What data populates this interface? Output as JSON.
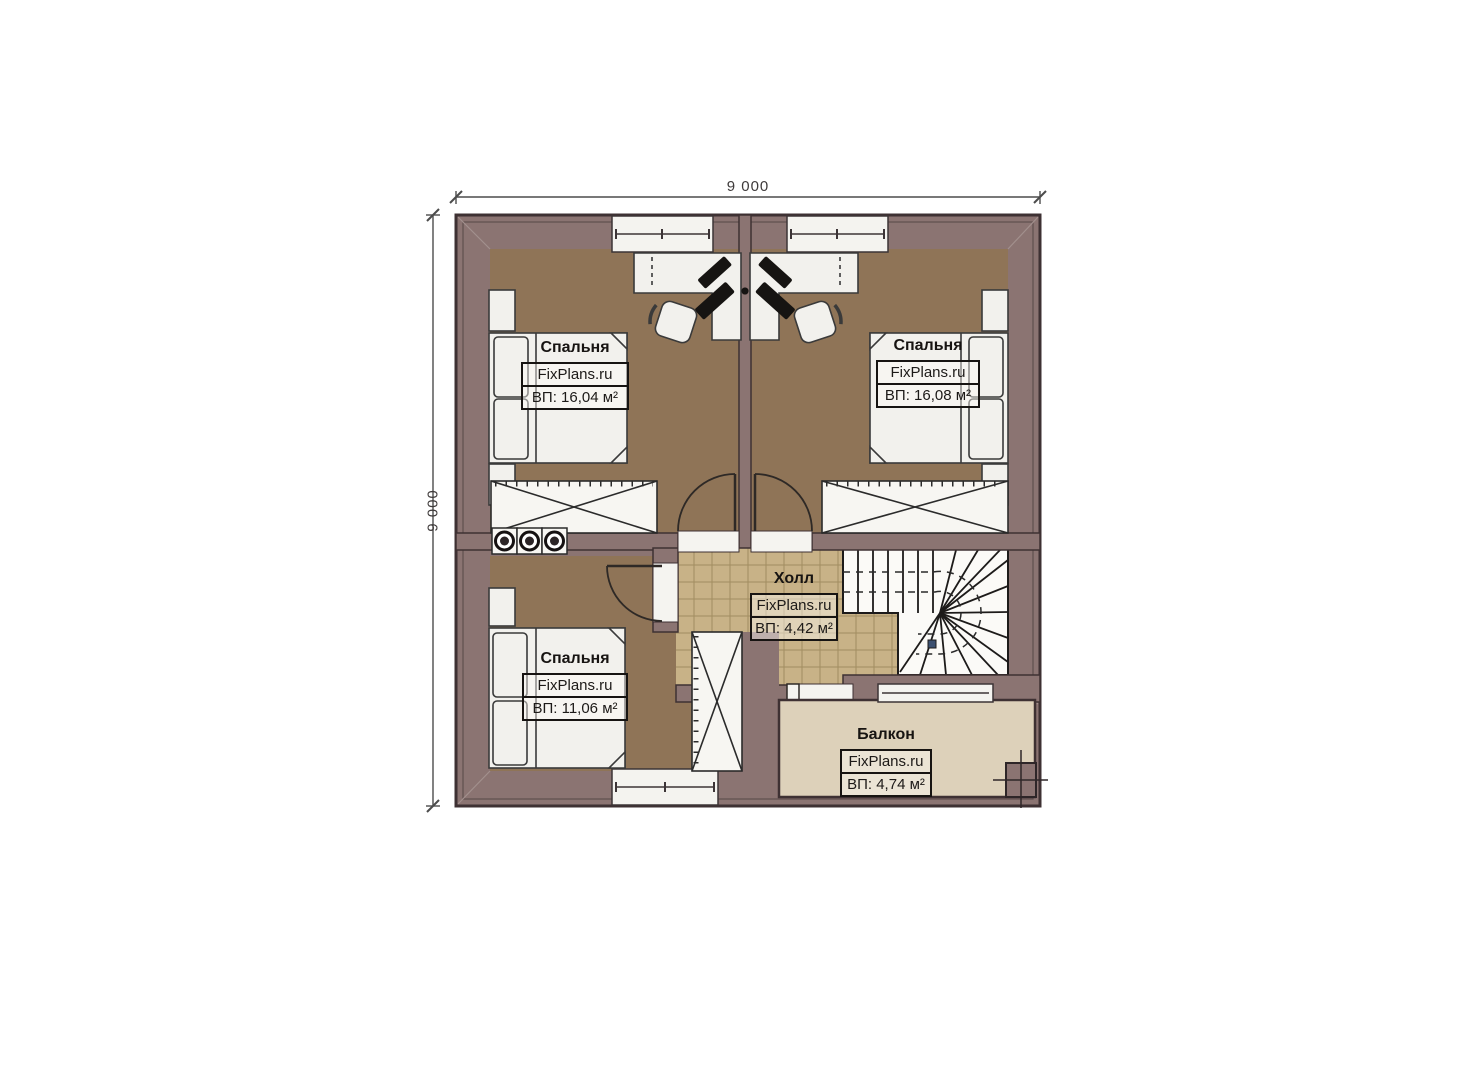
{
  "dimensions": {
    "width": "9 000",
    "height": "9 000"
  },
  "rooms": [
    {
      "id": "bedroom-top-left",
      "name": "Спальня",
      "watermark": "FixPlans.ru",
      "area": "ВП: 16,04 м²"
    },
    {
      "id": "bedroom-top-right",
      "name": "Спальня",
      "watermark": "FixPlans.ru",
      "area": "ВП: 16,08 м²"
    },
    {
      "id": "bedroom-bottom",
      "name": "Спальня",
      "watermark": "FixPlans.ru",
      "area": "ВП: 11,06 м²"
    },
    {
      "id": "hall",
      "name": "Холл",
      "watermark": "FixPlans.ru",
      "area": "ВП: 4,42 м²"
    },
    {
      "id": "balcony",
      "name": "Балкон",
      "watermark": "FixPlans.ru",
      "area": "ВП: 4,74 м²"
    }
  ],
  "colors": {
    "wall": "#8b7472",
    "outline": "#3e3133",
    "room_floor": "#8f7457",
    "hall_floor": "#c8b287",
    "balcony_floor": "#ddd1ba",
    "furniture": "#f2f1ed"
  }
}
